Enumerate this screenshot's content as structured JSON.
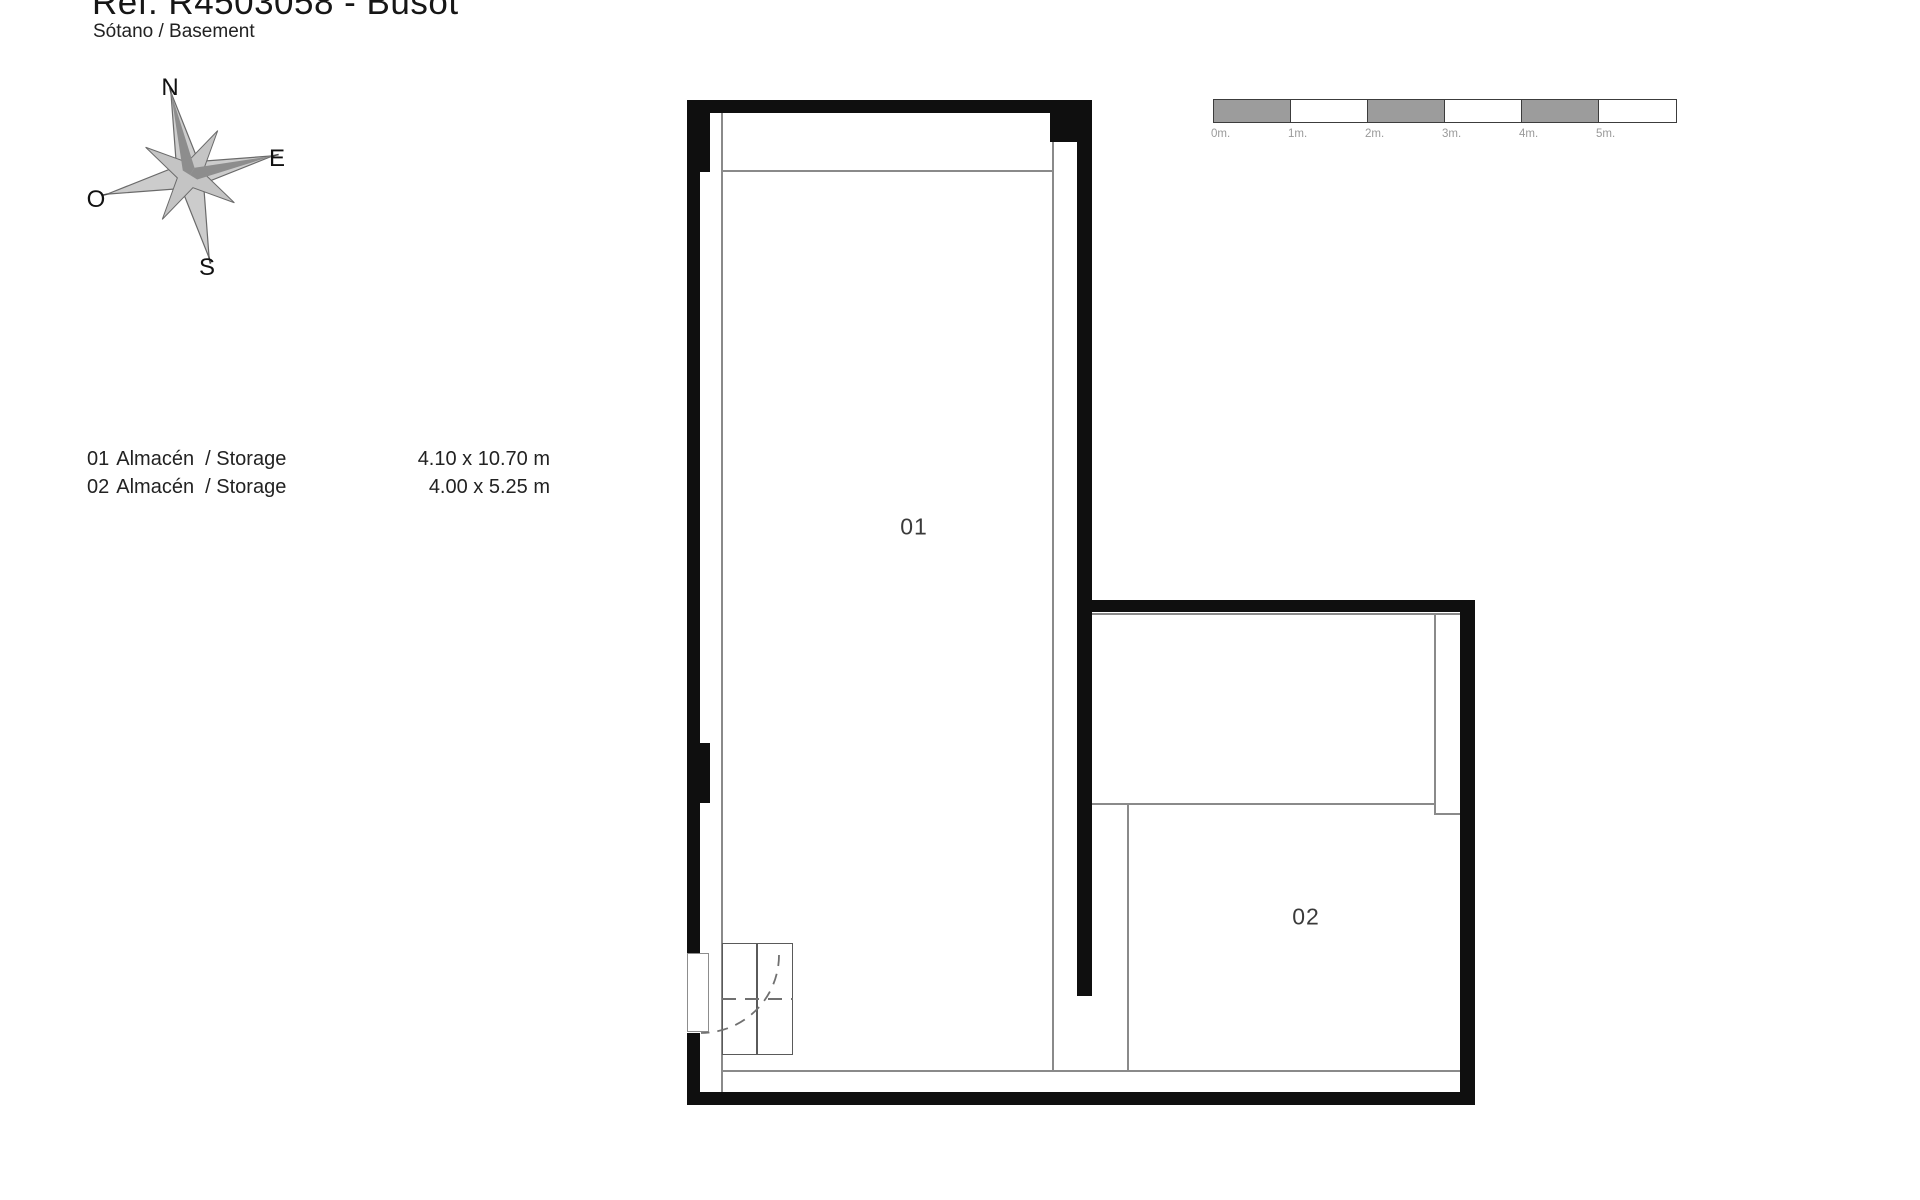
{
  "header": {
    "title": "Ref. R4503058 - Busot",
    "subtitle": "Sótano / Basement"
  },
  "compass": {
    "north": "N",
    "east": "E",
    "south": "S",
    "west": "O"
  },
  "scale_bar": {
    "labels": [
      "0m.",
      "1m.",
      "2m.",
      "3m.",
      "4m.",
      "5m."
    ],
    "segment_colors": [
      "#9c9c9c",
      "#ffffff",
      "#9c9c9c",
      "#ffffff",
      "#9c9c9c",
      "#ffffff"
    ],
    "meters_per_segment": 1
  },
  "legend": {
    "rows": [
      {
        "number": "01",
        "name": "Almacén  / Storage",
        "dimensions": "4.10 x 10.70 m"
      },
      {
        "number": "02",
        "name": "Almacén  / Storage",
        "dimensions": "4.00 x 5.25 m"
      }
    ]
  },
  "floor_plan": {
    "rooms": [
      {
        "label": "01"
      },
      {
        "label": "02"
      }
    ]
  },
  "colors": {
    "wall": "#0f0f0f",
    "interior_line": "#8a8a8a",
    "scale_gray": "#9c9c9c",
    "compass_fill": "#cccccc",
    "text": "#1a1a1a"
  }
}
